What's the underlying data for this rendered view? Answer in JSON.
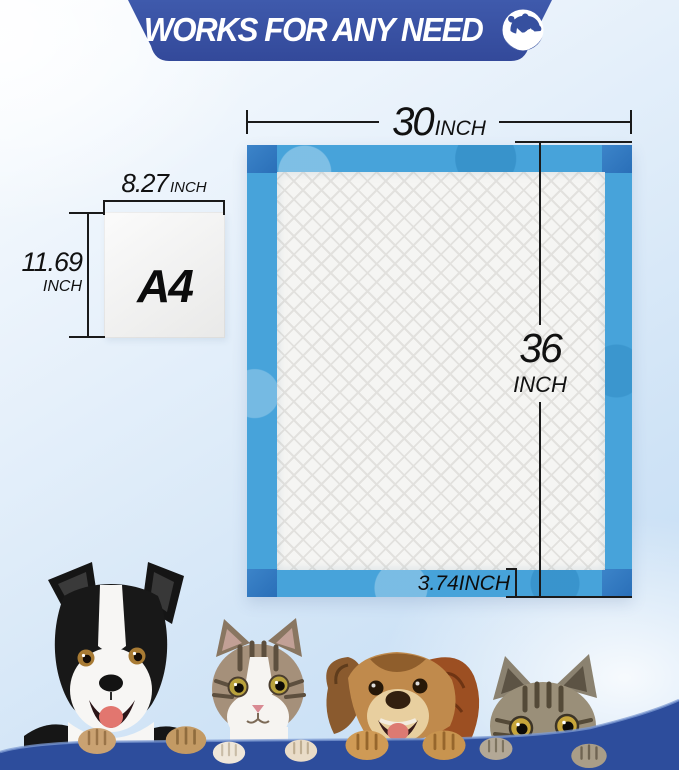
{
  "banner": {
    "title": "WORKS FOR ANY NEED",
    "logo_icon": "dog-and-cat-icon"
  },
  "pad": {
    "width": {
      "value": "30",
      "unit": "INCH"
    },
    "height": {
      "value": "36",
      "unit": "INCH"
    },
    "border": {
      "label": "3.74INCH"
    }
  },
  "a4": {
    "label": "A4",
    "width": {
      "value": "8.27",
      "unit": "INCH"
    },
    "height": {
      "value": "11.69",
      "unit": "INCH"
    }
  },
  "animals": {
    "items": [
      {
        "name": "border-collie-dog"
      },
      {
        "name": "tabby-white-cat"
      },
      {
        "name": "brown-dog"
      },
      {
        "name": "peeking-tabby-cat"
      }
    ]
  },
  "colors": {
    "banner_blue": "#3a55a5",
    "pad_blue": "#47a3da",
    "pad_corner_blue": "#2f77c0",
    "core_white": "#f5f5f3",
    "ledge_blue": "#2d4d9c",
    "dimension_line": "#1a1a1a"
  }
}
